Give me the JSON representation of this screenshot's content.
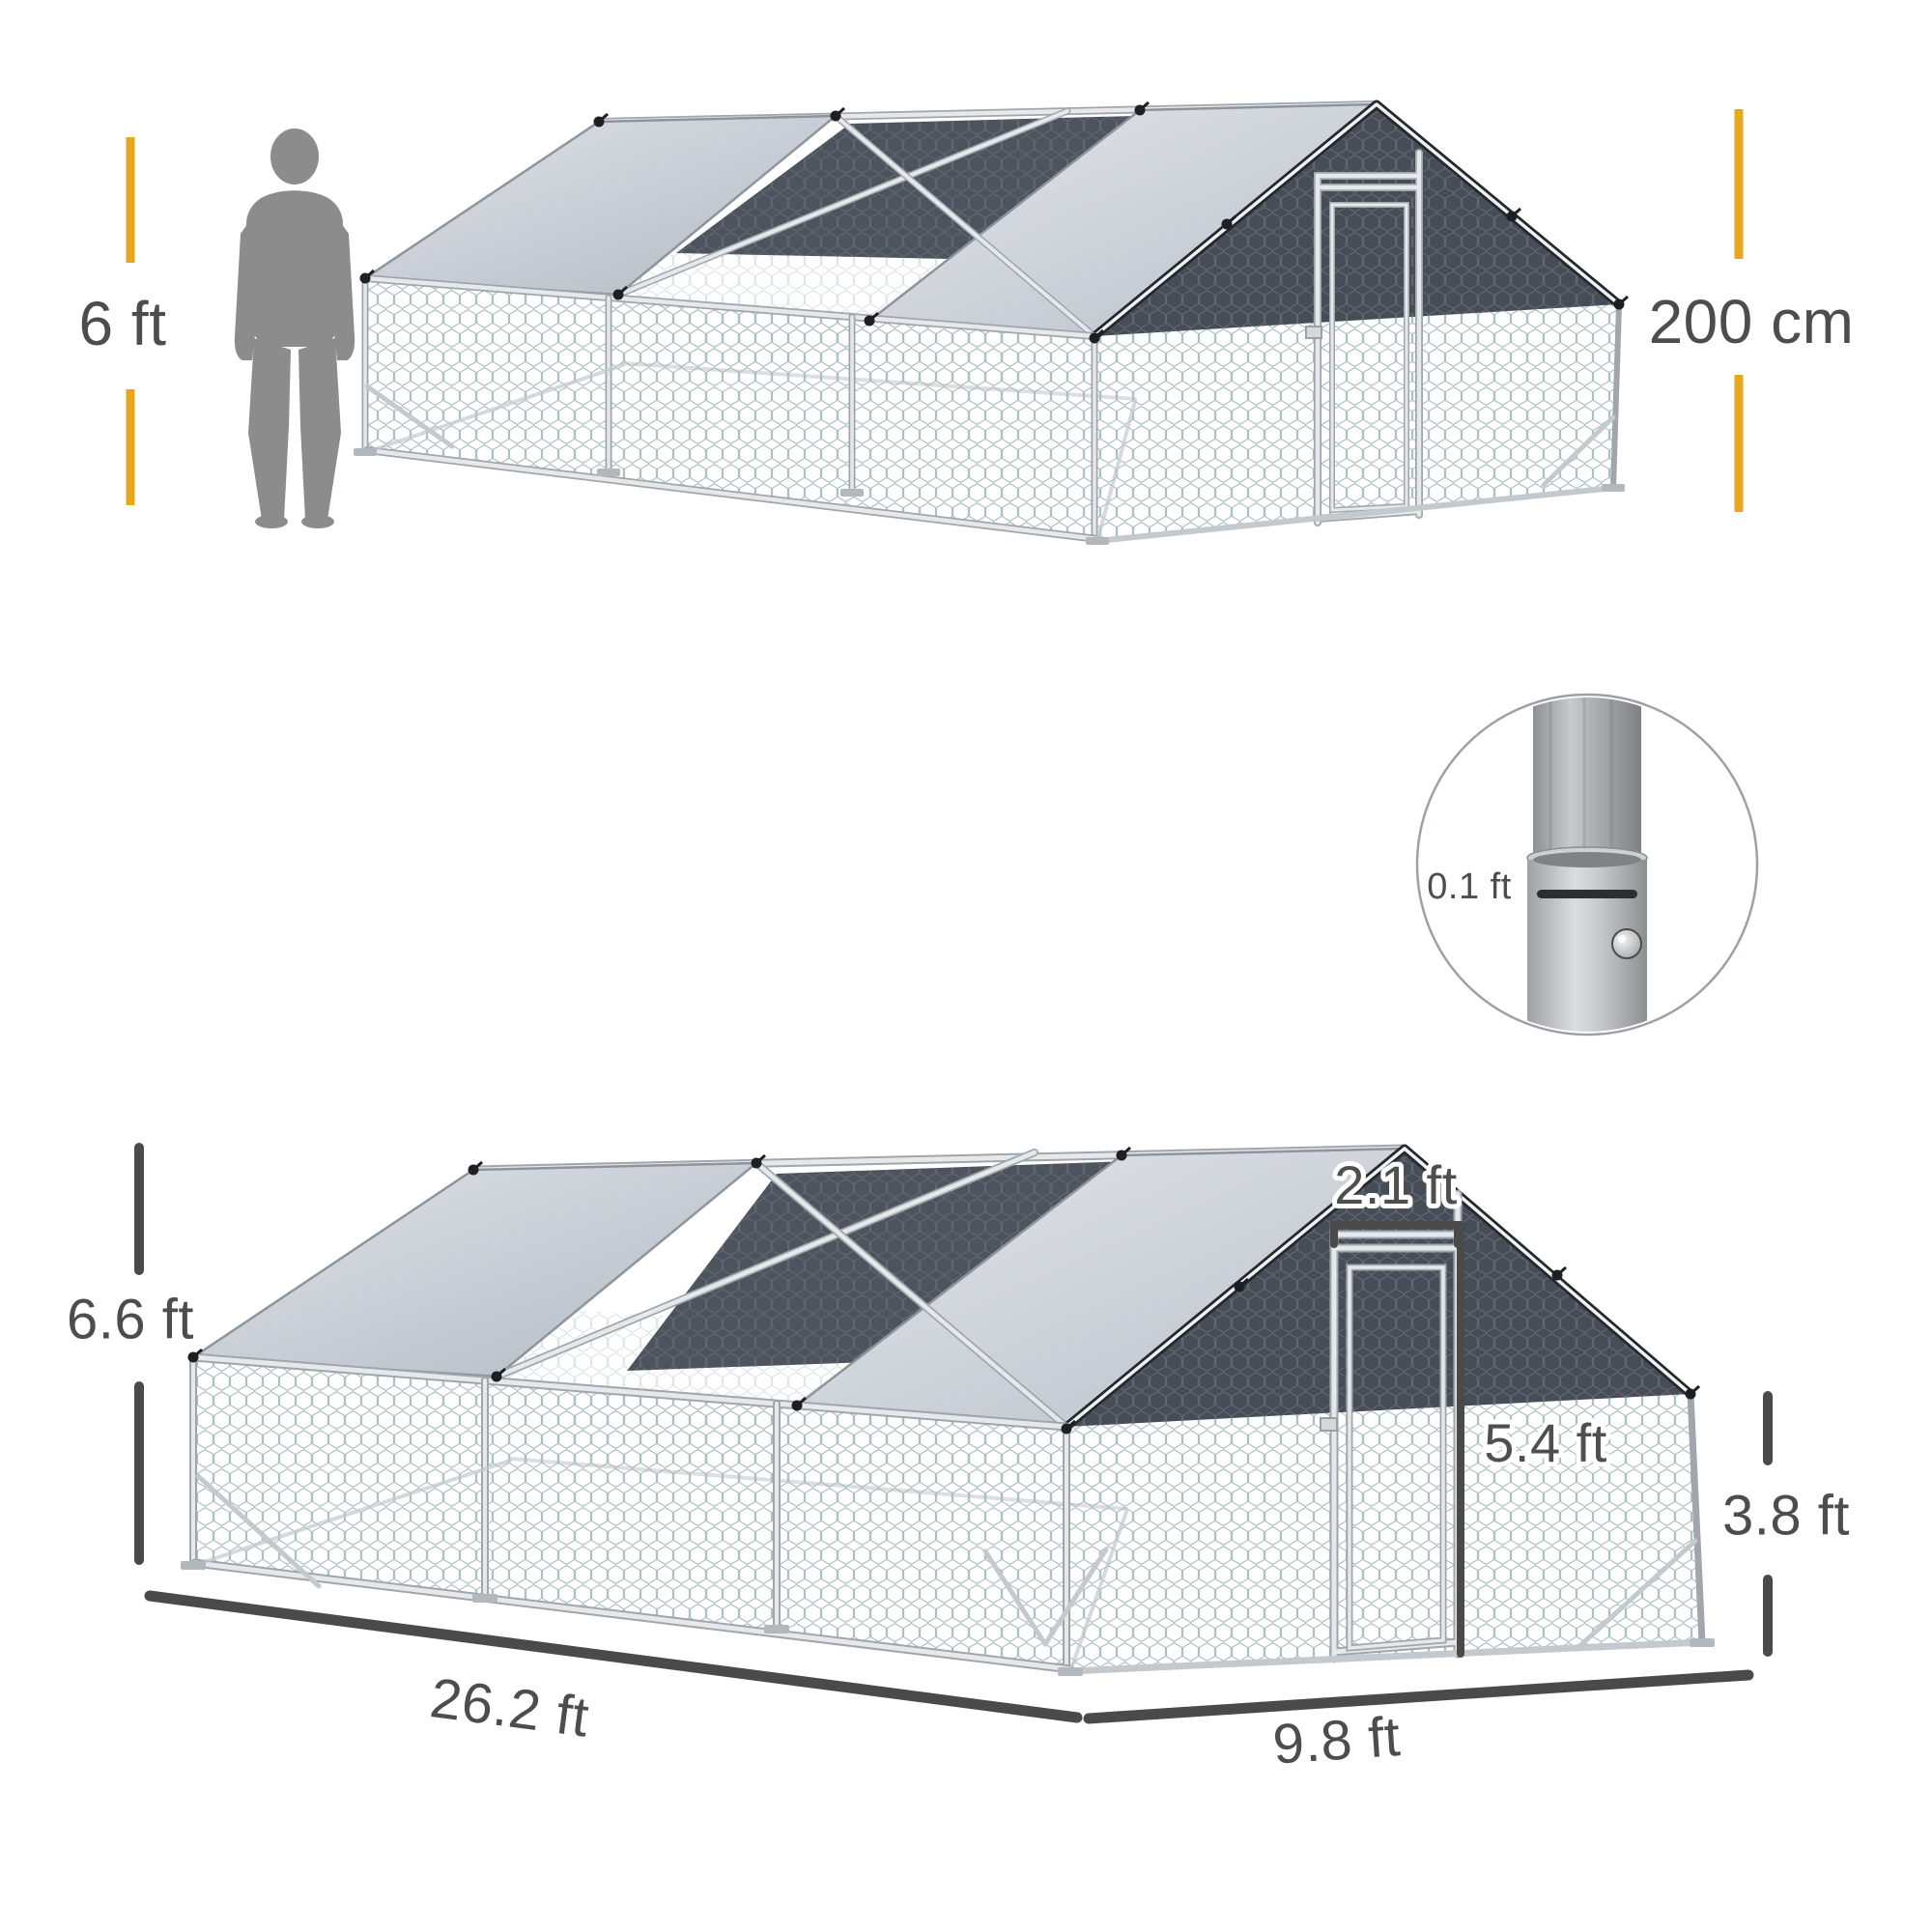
{
  "figure": {
    "kind": "product-dimensions-infographic",
    "subject": "walk-in galvanized chicken run cage with gable roof, hex wire mesh, partial tarp covers and front door"
  },
  "labels": {
    "human_height": "6 ft",
    "cage_height_metric": "200 cm",
    "pole_diameter": "0.1 ft",
    "total_height": "6.6 ft",
    "door_width": "2.1 ft",
    "door_height": "5.4 ft",
    "wall_height": "3.8 ft",
    "run_length": "26.2 ft",
    "run_width": "9.8 ft"
  },
  "icons": [
    "human-scale-silhouette-icon",
    "pole-joint-detail-circle-icon",
    "chicken-run-render",
    "tarp-clip-icon"
  ],
  "colors": {
    "accent_yellow": "#E7A81E",
    "dimension_gray": "#4A4A4A",
    "text_gray": "#4D4D4D",
    "silhouette_gray": "#8C8C8C",
    "tarp_light_gray": "#C9CED6",
    "shade_cloth_dark": "#4D545E",
    "mesh_teal": "#A6BEC0",
    "frame_silver": "#E6E9EB",
    "background": "#FFFFFF"
  }
}
